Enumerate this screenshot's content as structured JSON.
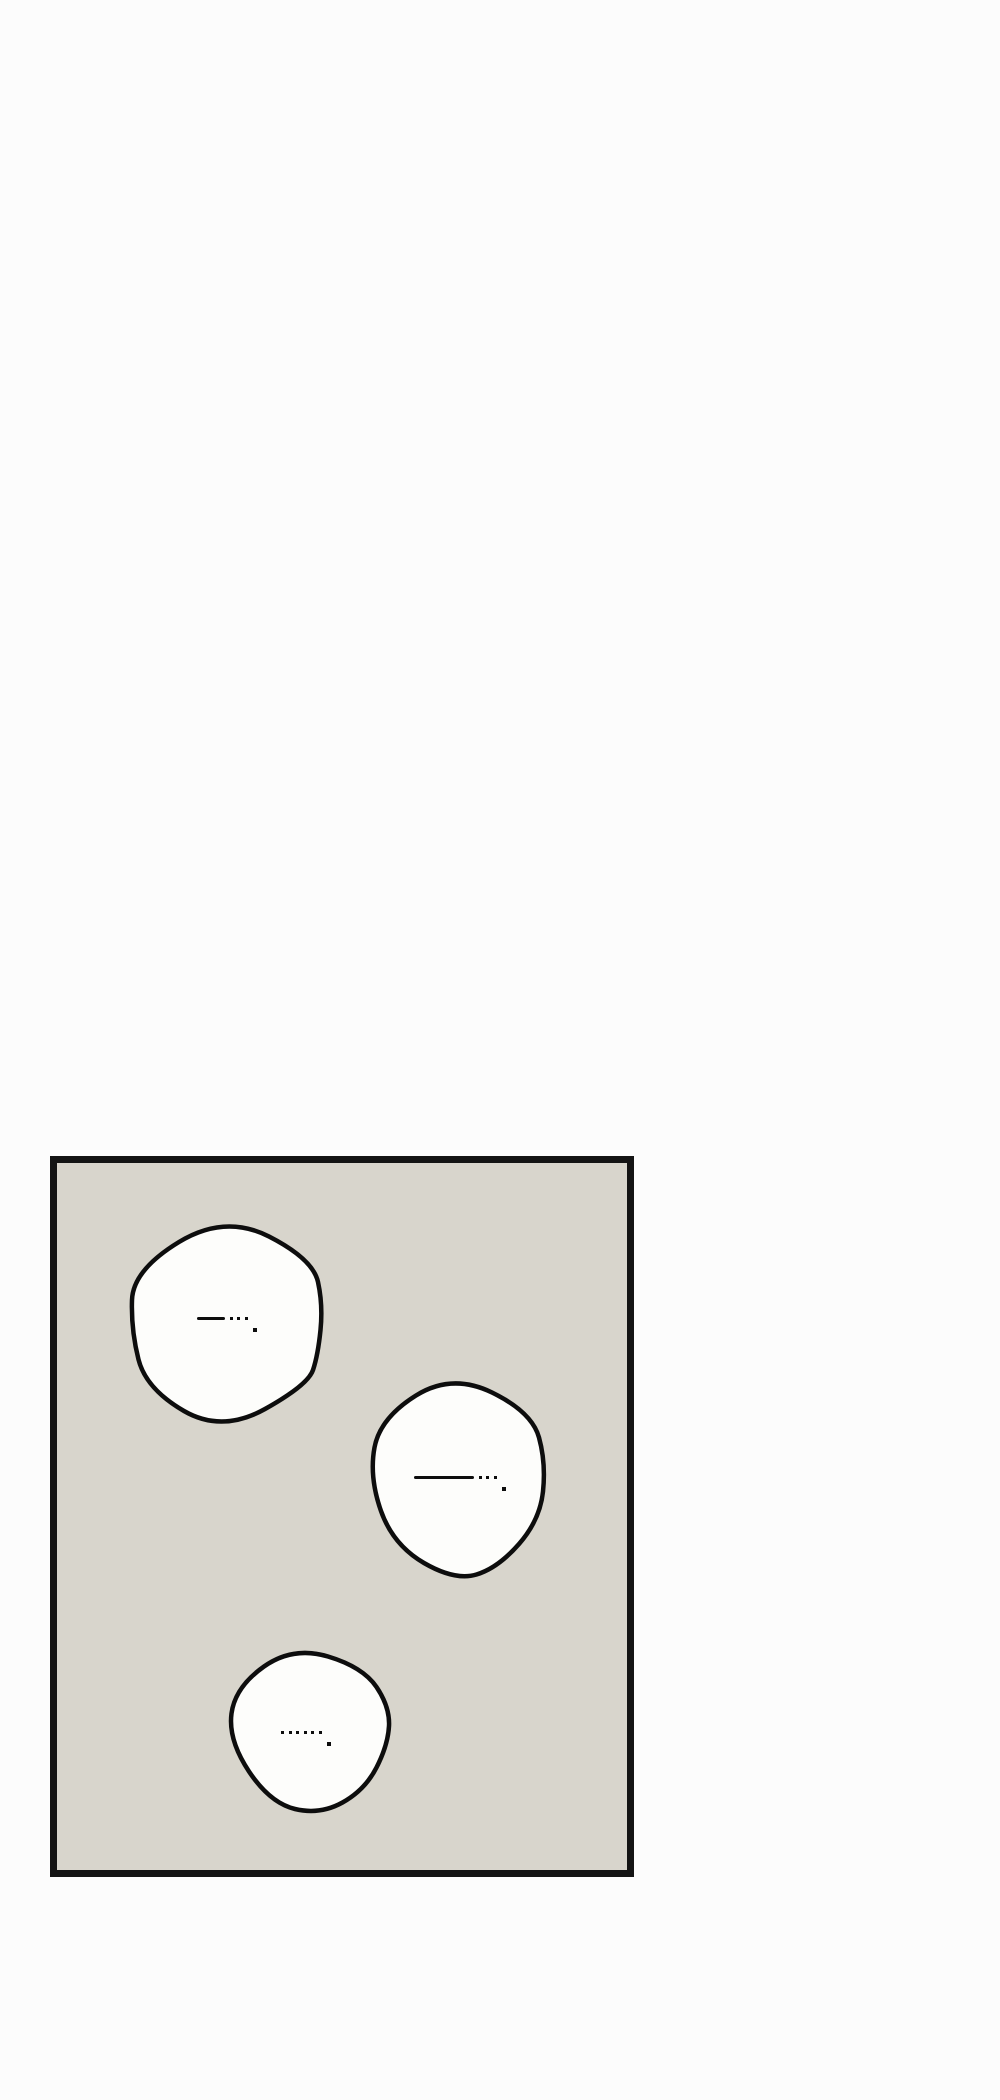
{
  "page": {
    "background_color": "#fcfcfc"
  },
  "panel": {
    "fill_color": "#d8d5cc",
    "border_color": "#141414",
    "line_color": "#0d0d0d",
    "bubble_fill_color": "#fdfdfb",
    "bubbles": [
      {
        "name": "speech-bubble-1",
        "dialogue": "—··· .",
        "marks": {
          "dash_width": 28,
          "dot_count": 3,
          "period": true
        }
      },
      {
        "name": "speech-bubble-2",
        "dialogue": "——··· .",
        "marks": {
          "dash_width": 60,
          "dot_count": 3,
          "period": true
        }
      },
      {
        "name": "speech-bubble-3",
        "dialogue": "······ .",
        "marks": {
          "dash_width": 0,
          "dot_count": 6,
          "period": true
        }
      }
    ]
  }
}
